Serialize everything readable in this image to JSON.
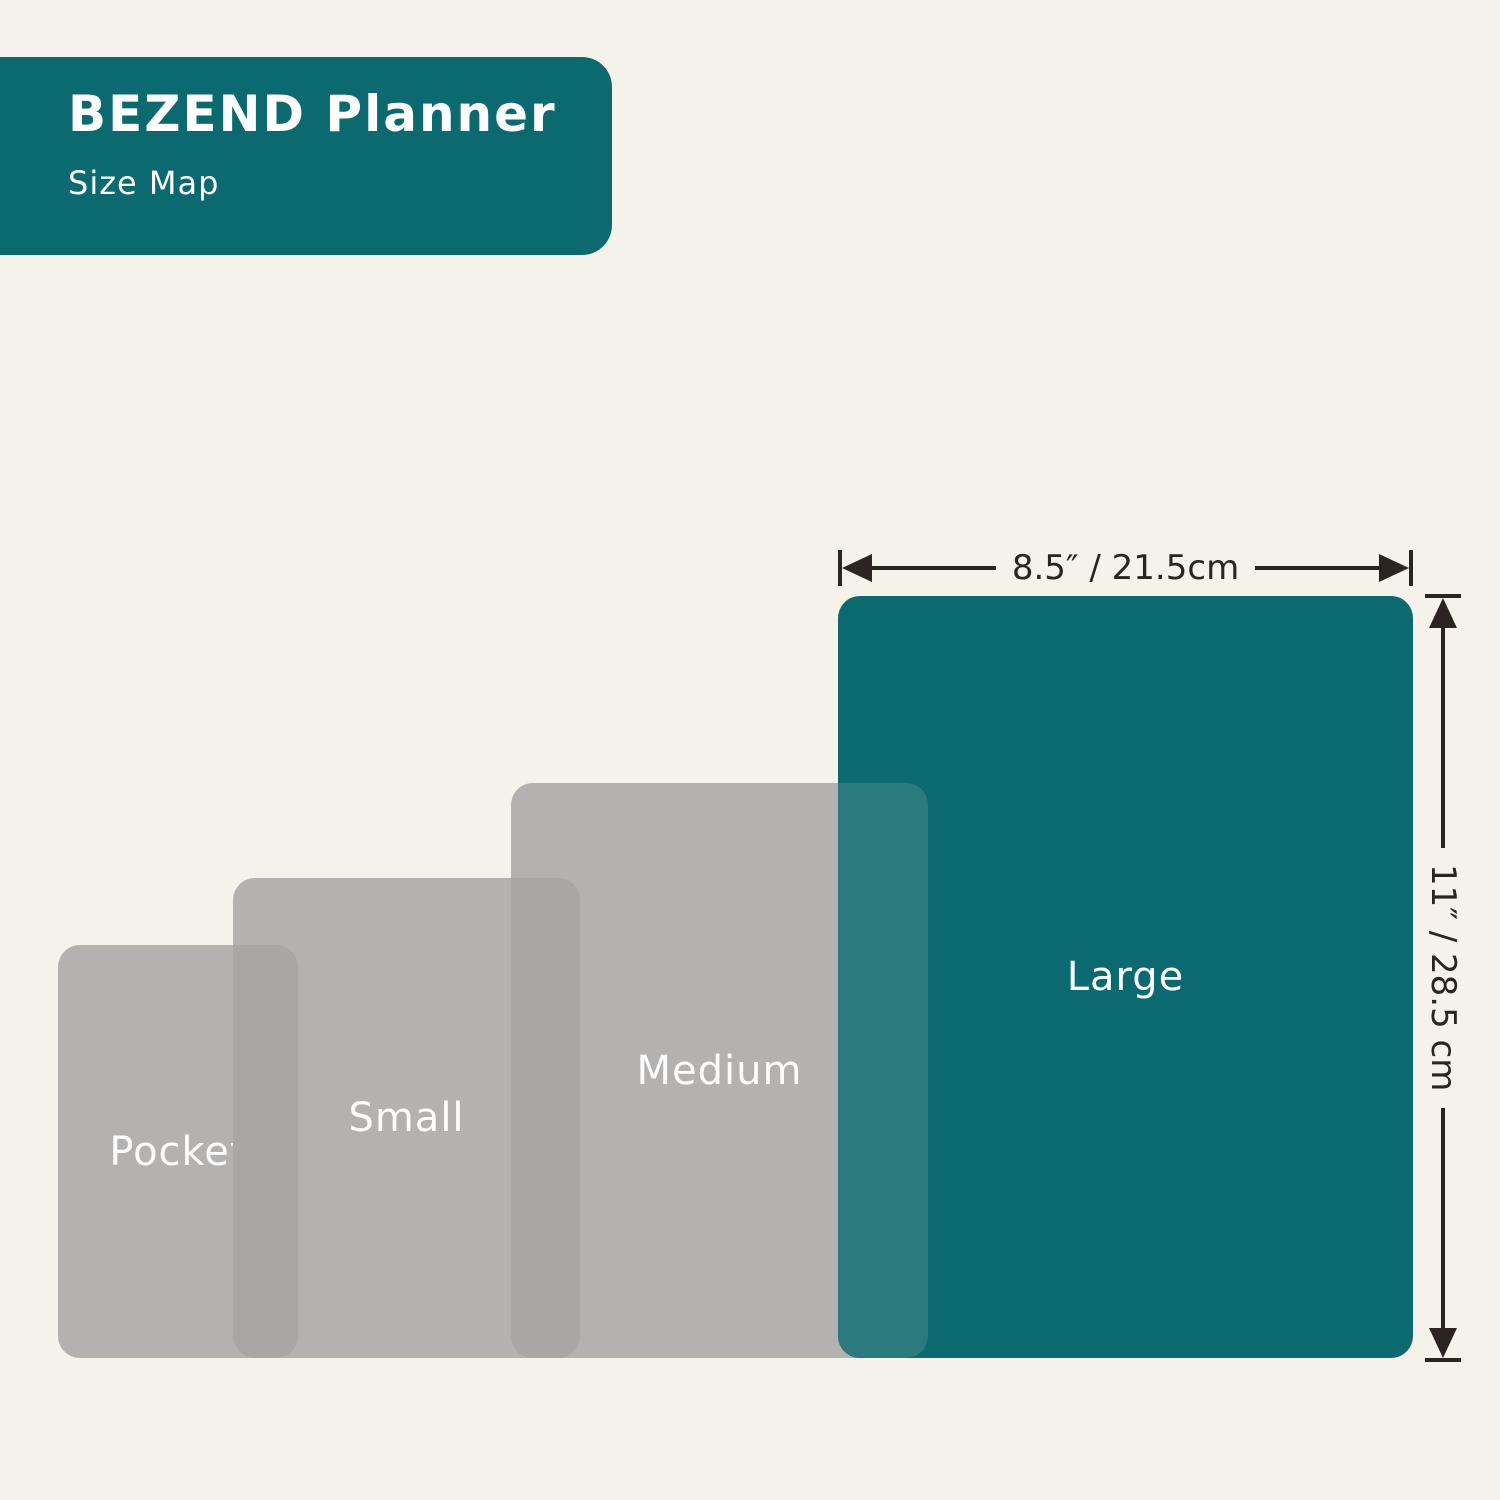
{
  "header": {
    "title": "BEZEND Planner",
    "subtitle": "Size Map"
  },
  "sizes": [
    {
      "label": "Pocket",
      "highlight": false
    },
    {
      "label": "Small",
      "highlight": false
    },
    {
      "label": "Medium",
      "highlight": false
    },
    {
      "label": "Large",
      "highlight": true
    }
  ],
  "dimensions": {
    "width_label": "8.5″ / 21.5cm",
    "height_label": "11″ / 28.5 cm"
  },
  "colors": {
    "background": "#F5F2E9",
    "teal": "#0B6A70",
    "teal_overlap": "#2B7A7E",
    "gray": "#B4B2B1",
    "gray_overlap": "#A9A7A6",
    "arrow": "#2B2420",
    "label_text": "#FFFFFF"
  }
}
